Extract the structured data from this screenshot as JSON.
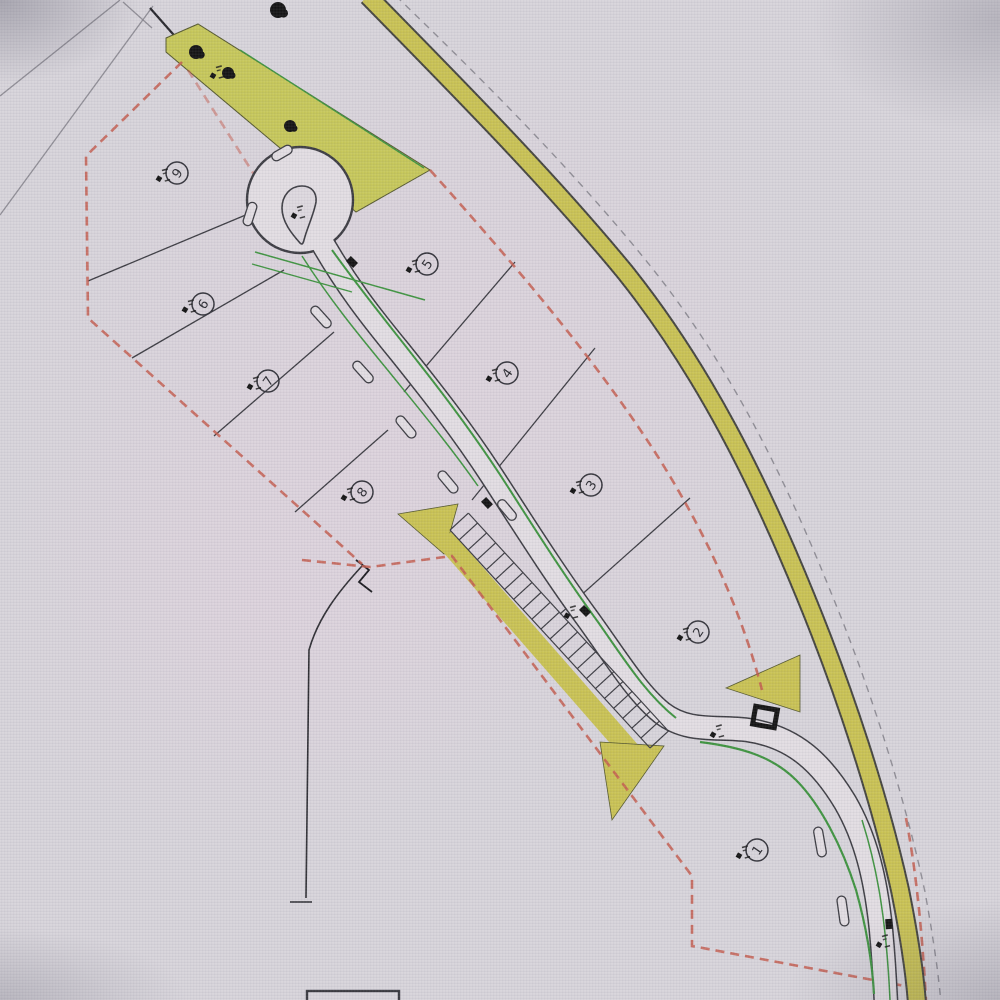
{
  "drawing": {
    "type": "residential site layout plan",
    "plots": [
      {
        "label": "9",
        "x": 177,
        "y": 173
      },
      {
        "label": "5",
        "x": 427,
        "y": 264
      },
      {
        "label": "6",
        "x": 203,
        "y": 304
      },
      {
        "label": "7",
        "x": 268,
        "y": 381
      },
      {
        "label": "8",
        "x": 362,
        "y": 492
      },
      {
        "label": "4",
        "x": 507,
        "y": 373
      },
      {
        "label": "3",
        "x": 591,
        "y": 485
      },
      {
        "label": "2",
        "x": 698,
        "y": 632
      },
      {
        "label": "1",
        "x": 757,
        "y": 850
      }
    ],
    "survey_markers": [
      {
        "x": 293,
        "y": 216
      },
      {
        "x": 212,
        "y": 76
      },
      {
        "x": 712,
        "y": 735
      },
      {
        "x": 878,
        "y": 945
      },
      {
        "x": 566,
        "y": 616
      }
    ],
    "road_gullies": [
      {
        "x": 352,
        "y": 262,
        "rot": 44
      },
      {
        "x": 487,
        "y": 503,
        "rot": 47
      },
      {
        "x": 585,
        "y": 611,
        "rot": 46
      },
      {
        "x": 889,
        "y": 924,
        "rot": 86
      }
    ],
    "utility_box": {
      "x": 765,
      "y": 717,
      "rot": 10
    },
    "tree_symbols": [
      {
        "x": 196,
        "y": 52,
        "r": 7
      },
      {
        "x": 228,
        "y": 73,
        "r": 6
      },
      {
        "x": 290,
        "y": 126,
        "r": 6
      },
      {
        "x": 278,
        "y": 10,
        "r": 8
      }
    ],
    "passing_bays": [
      {
        "x": 250,
        "y": 214,
        "rot": -72,
        "len": 24
      },
      {
        "x": 282,
        "y": 153,
        "rot": -30,
        "len": 22
      },
      {
        "x": 321,
        "y": 317,
        "rot": 48,
        "len": 26
      },
      {
        "x": 363,
        "y": 372,
        "rot": 48,
        "len": 26
      },
      {
        "x": 406,
        "y": 427,
        "rot": 50,
        "len": 26
      },
      {
        "x": 448,
        "y": 482,
        "rot": 50,
        "len": 26
      },
      {
        "x": 507,
        "y": 510,
        "rot": 50,
        "len": 24
      },
      {
        "x": 820,
        "y": 842,
        "rot": 80,
        "len": 30
      },
      {
        "x": 843,
        "y": 911,
        "rot": 82,
        "len": 30
      }
    ],
    "parking_row": {
      "x1": 450,
      "y1": 530,
      "x2": 650,
      "y2": 748,
      "width": 25,
      "bays": 22
    },
    "colors": {
      "paper": "#d7d4da",
      "road_fill": "#e2dde2",
      "pink_cast": "#e8d3e0",
      "verge_yellow": "#c9c254",
      "planting_green": "#3f9440",
      "boundary_red": "#c45e50",
      "line_dark": "#3c3c42",
      "line_grey": "#8f8d95",
      "marker_black": "#141414"
    }
  }
}
